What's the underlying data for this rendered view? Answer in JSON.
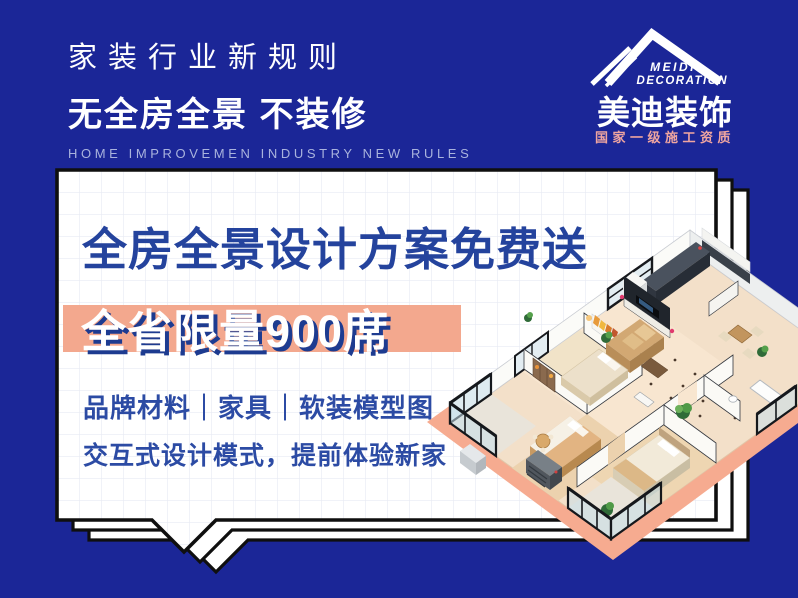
{
  "header": {
    "tagline_top": "家装行业新规则",
    "tagline_main": "无全房全景 不装修",
    "tagline_en": "HOME IMPROVEMEN INDUSTRY NEW RULES"
  },
  "logo": {
    "name_en_line1": "MEIDI",
    "name_en_line2": "DECORATION",
    "name_cn": "美迪装饰",
    "qualification": "国家一级施工资质"
  },
  "card": {
    "headline": "全房全景设计方案免费送",
    "highlight": "全省限量900席",
    "features": [
      "品牌材料｜家具｜软装模型图",
      "交互式设计模式，提前体验新家"
    ]
  },
  "illustration": {
    "name": "3d-apartment-floorplan"
  },
  "colors": {
    "background_blue": "#1b2697",
    "navy_text": "#24439d",
    "salmon_band": "#f3a88e",
    "salmon_platform": "#f6ab90",
    "logo_sub_salmon": "#efa5a0",
    "card_grid": "#e8eaf3",
    "outline_black": "#0f0f0f"
  }
}
